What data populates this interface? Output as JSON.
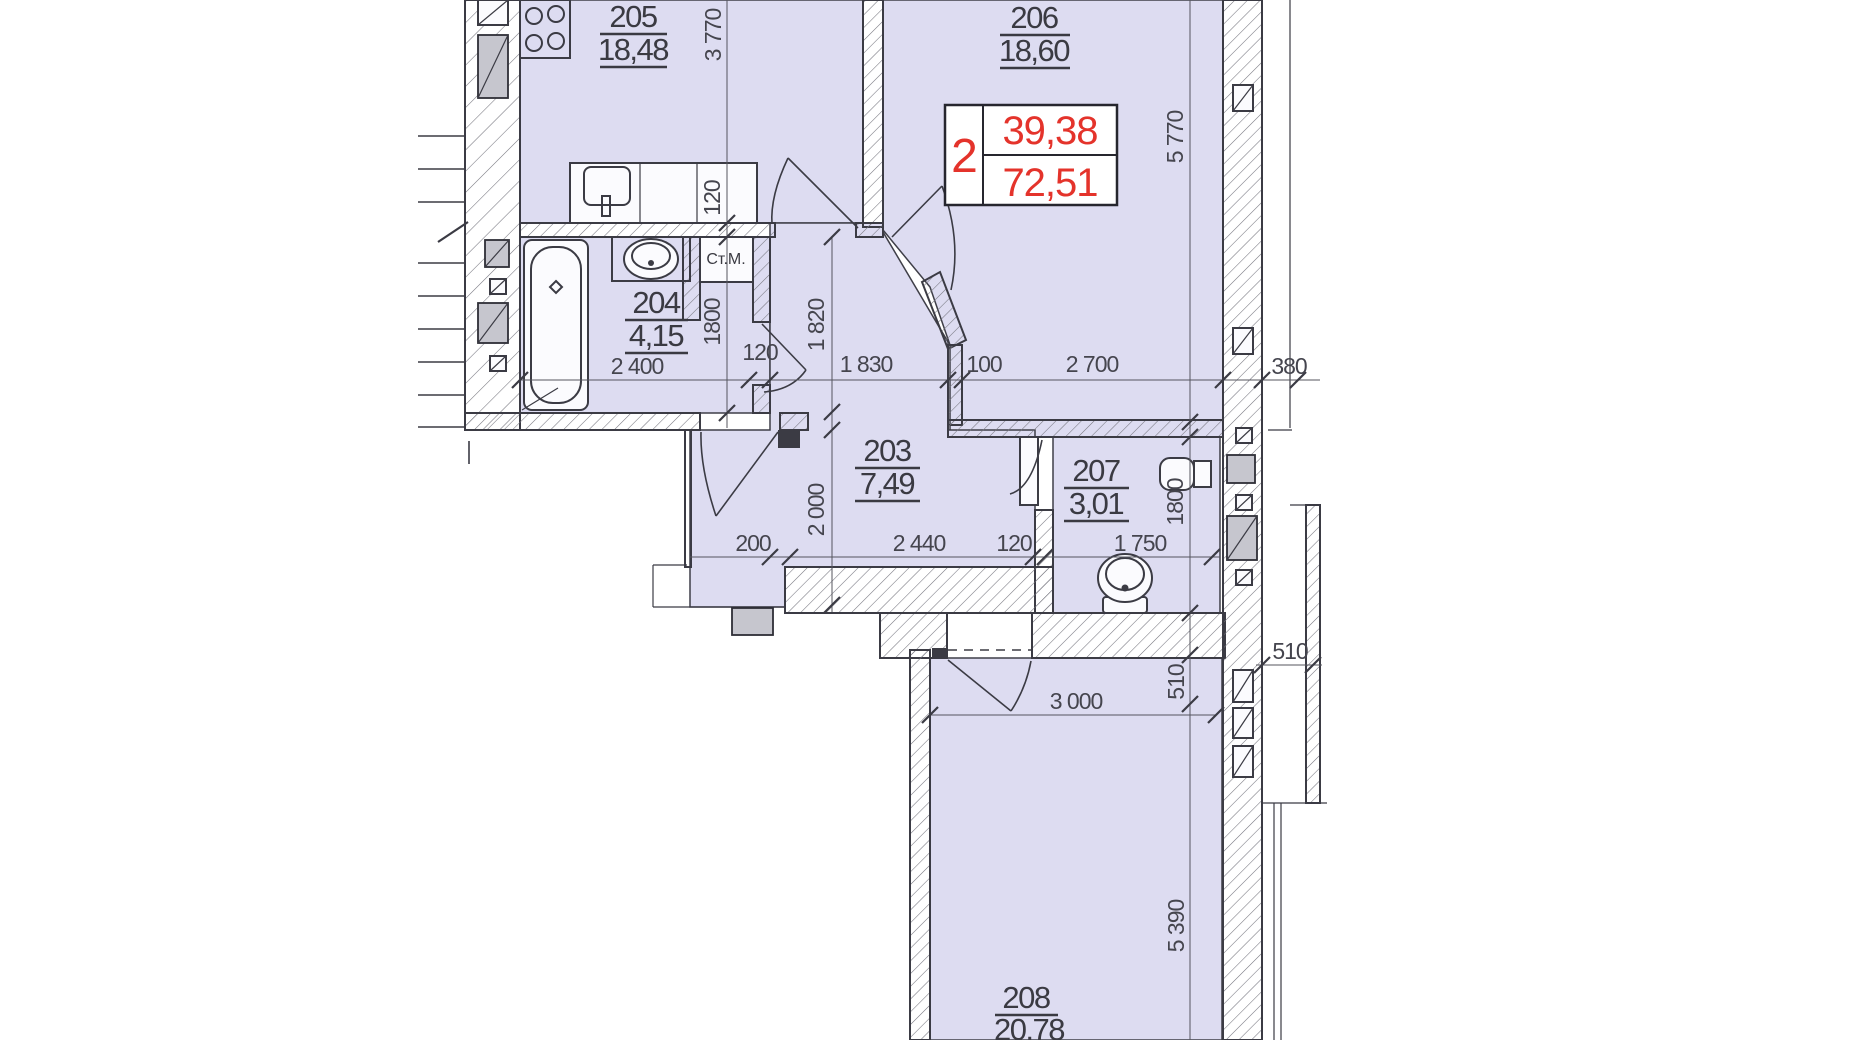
{
  "plan": {
    "stamp": {
      "number": "2",
      "value_top": "39,38",
      "value_bottom": "72,51"
    },
    "rooms": {
      "kitchen": {
        "number": "205",
        "area": "18,48"
      },
      "living": {
        "number": "206",
        "area": "18,60"
      },
      "bath": {
        "number": "204",
        "area": "4,15"
      },
      "hall": {
        "number": "203",
        "area": "7,49"
      },
      "wc": {
        "number": "207",
        "area": "3,01"
      },
      "bedroom": {
        "number": "208",
        "area": "20,78"
      }
    },
    "labels": {
      "washing_machine": "Ст.М."
    },
    "dims": {
      "d3770": "3 770",
      "d5770": "5 770",
      "d120a": "120",
      "d1800a": "1800",
      "d2400": "2 400",
      "d1820": "1 820",
      "d120b": "120",
      "d1830": "1 830",
      "d100": "100",
      "d2700": "2 700",
      "d380": "380",
      "d200": "200",
      "d2000": "2 000",
      "d2440": "2 440",
      "d120c": "120",
      "d1750": "1 750",
      "d1800b": "1800",
      "d510a": "510",
      "d510b": "510",
      "d3000": "3 000",
      "d5390": "5 390"
    },
    "colors": {
      "room_fill": "#dddcf1",
      "line": "#3b3b44",
      "accent_red": "#e4332b",
      "gray_fill": "#c6c6ce"
    }
  }
}
